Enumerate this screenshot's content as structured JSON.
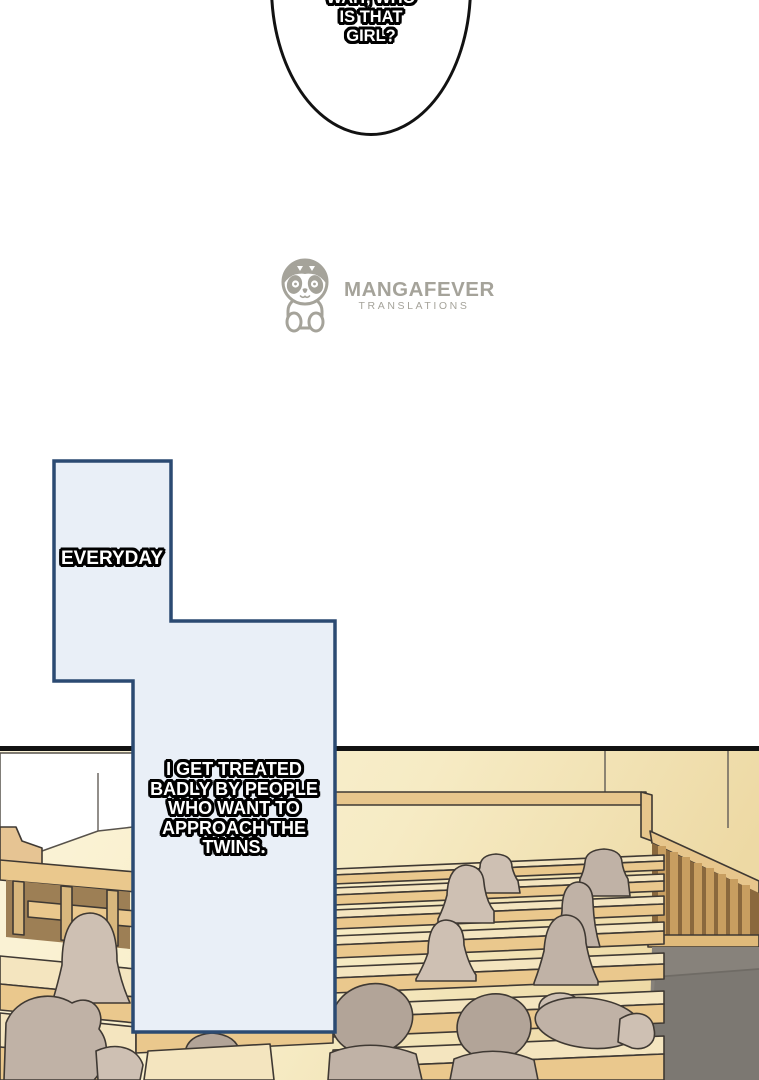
{
  "comic": {
    "dialogue_bubble_top": {
      "lines": [
        "WAIT, WHO",
        "IS THAT",
        "GIRL?"
      ]
    },
    "caption_everyday": {
      "text": "EVERYDAY"
    },
    "caption_narration": {
      "lines": [
        "I GET TREATED",
        "BADLY BY PEOPLE",
        "WHO WANT TO",
        "APPROACH THE",
        "TWINS."
      ]
    }
  },
  "watermark": {
    "brand": "MANGAFEVER",
    "subtitle": "TRANSLATIONS",
    "mascot": "sloth-mascot-icon"
  },
  "colors": {
    "ink": "#121212",
    "bubble_fill": "#e9eff7",
    "bubble_border": "#2b4a72",
    "logo_gray": "#a5a39a",
    "outline": "#3f3933",
    "wall_light": "#fcf5da",
    "wall_mid": "#f6ebc4",
    "wall_shade": "#edd9a4",
    "desk": "#eac88d",
    "seatback": "#f4e5bf",
    "ledge": "#e7c68c",
    "sill": "#e0ba7a",
    "slat": "#c89e60",
    "slat_bg": "#8a683d",
    "leg": "#d8b77d",
    "desk_shadow": "#9d7f55",
    "aisle": "#87827b",
    "aisle_dark": "#7c7872",
    "figure": "#cec0b3",
    "figure_dark": "#c0b2a6",
    "hair": "#b2a498",
    "screen_white": "#ffffff",
    "step_figure": "#e6c493"
  }
}
